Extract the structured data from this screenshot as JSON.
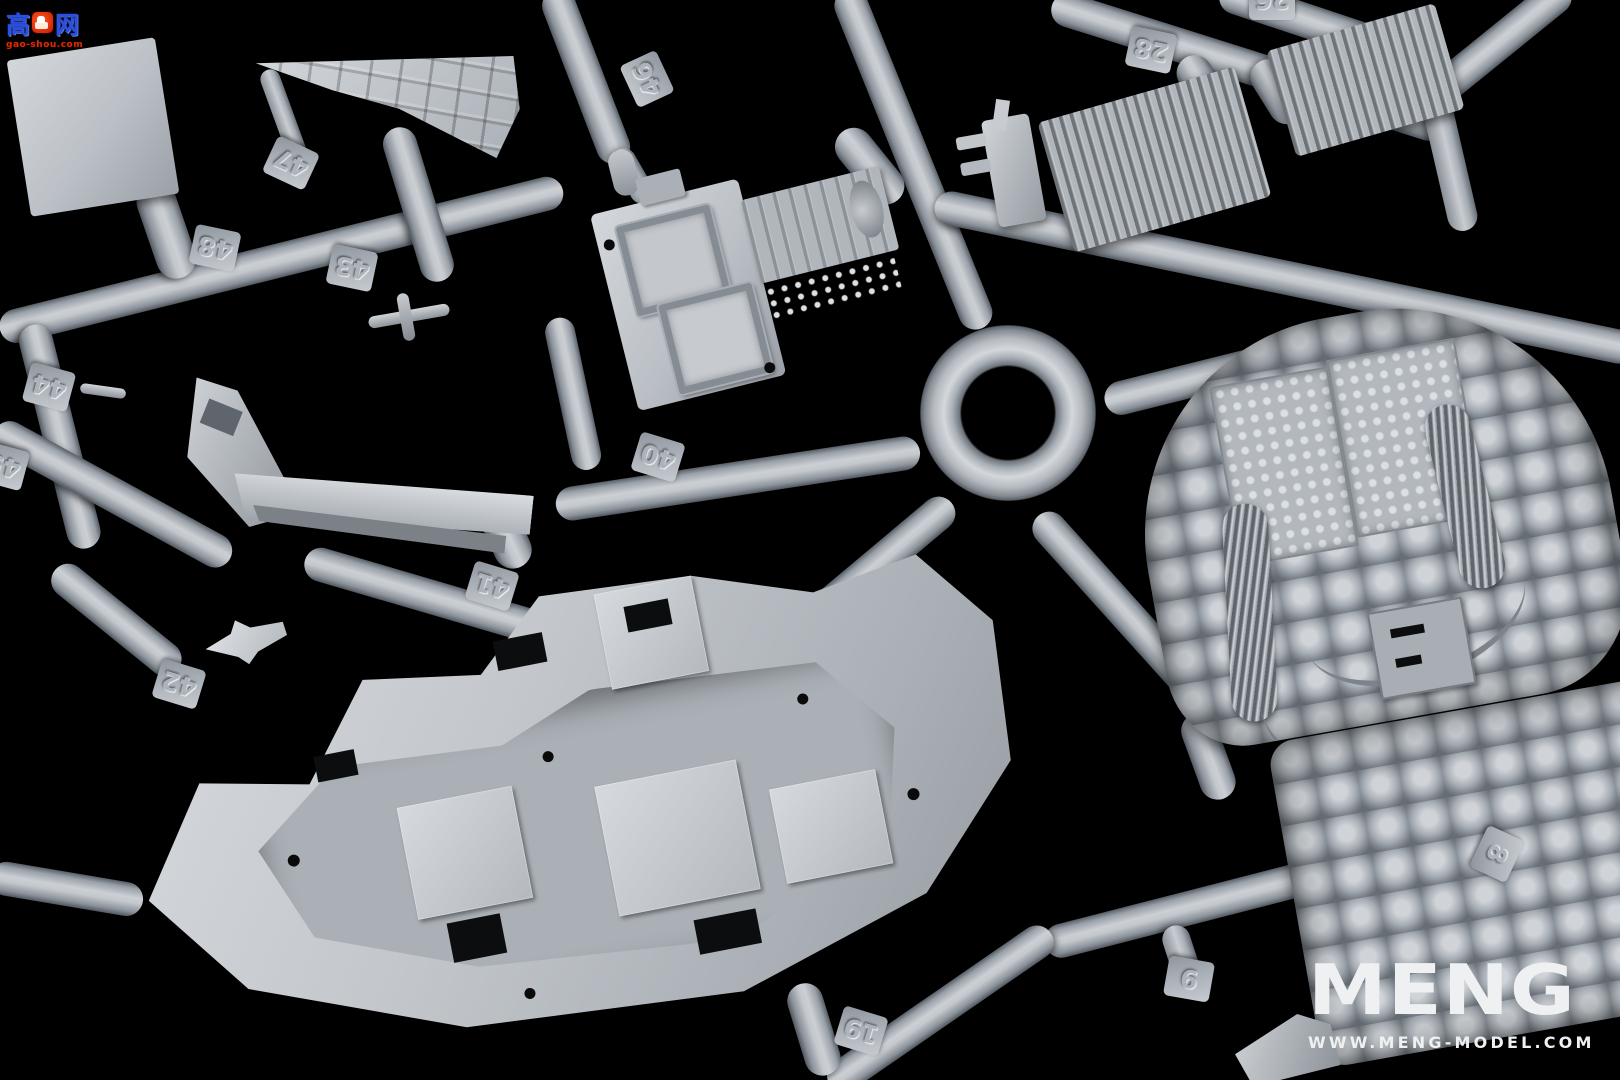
{
  "watermark": {
    "cn_left": "高",
    "thumb_icon": "thumb-up-icon",
    "cn_right": "网",
    "url": "gao-shou.com",
    "blue": "#2b50e0",
    "red": "#e02800"
  },
  "brand": {
    "logo_text": "MENG",
    "website": "WWW.MENG-MODEL.COM",
    "color": "#eef0f2"
  },
  "sprue": {
    "plastic_color": "#b7bcc2",
    "background_color": "#000000",
    "tags": [
      {
        "number": "48"
      },
      {
        "number": "43"
      },
      {
        "number": "47"
      },
      {
        "number": "46"
      },
      {
        "number": "44"
      },
      {
        "number": "45",
        "partial": true
      },
      {
        "number": "42"
      },
      {
        "number": "41"
      },
      {
        "number": "40"
      },
      {
        "number": "28"
      },
      {
        "number": "26",
        "partial": true
      },
      {
        "number": "8"
      },
      {
        "number": "9"
      },
      {
        "number": "19"
      }
    ]
  }
}
